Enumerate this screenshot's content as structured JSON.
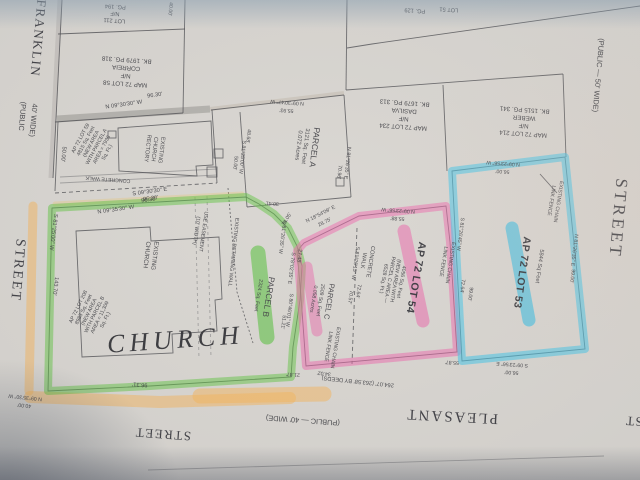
{
  "streets": {
    "left": {
      "name": "FRANKLIN",
      "designation_line1": "(PUBLIC",
      "designation_line2": "40' WIDE)",
      "word": "STREET"
    },
    "right": {
      "designation": "(PUBLIC   —   50' WIDE)",
      "word": "STREET"
    },
    "bottom": {
      "name": "PLEASANT",
      "designation": "(PUBLIC   —   40' WIDE)",
      "word": "STREET",
      "fragment": "ST"
    }
  },
  "abutters": {
    "lot211": [
      "LOT 211",
      "N/F",
      "PG. 194"
    ],
    "lot58": [
      "MAP 72 LOT 58",
      "N/F",
      "CORREIA",
      "BK. 1979 PG. 318"
    ],
    "lot234": [
      "MAP 72 LOT 234",
      "N/F",
      "DASILVA",
      "BK. 1679 PG. 313"
    ],
    "lot214": [
      "MAP 72 LOT 214",
      "N/F",
      "WEBER",
      "BK. 1515 PG. 341"
    ],
    "lot51_fragment": "LOT 51",
    "lot51_book_fragment": "PG. 129"
  },
  "subject_parcels": {
    "lot59": [
      "AP 72 LOT 59",
      "4815 Sq. Feet",
      "(NEW AREA",
      "WITH PARCEL A",
      "AREA = 7936",
      "Sq. Ft.)"
    ],
    "lot208": [
      "AP 72 LOT 208",
      "8985 Sq. Feet",
      "(NEW AREA",
      "WITH PARCEL B",
      "AREA = 11,309",
      "Sq. Ft.)"
    ],
    "parcel_a": [
      "PARCEL A",
      "3121 Sq. Feet",
      "0.072 Acres"
    ],
    "parcel_b": [
      "PARCEL B",
      "2324 Sq. Feet"
    ],
    "parcel_c": [
      "PARCEL C",
      "2509 Sq. Feet",
      "0.058 Acres"
    ],
    "lot54_title": "AP 72 LOT 54",
    "lot54_details": [
      "4056 Sq. Feet",
      "(NEW AREA WITH",
      "PARCEL C AREA —",
      "6528 Sq. Ft.)"
    ],
    "lot53_title": "AP 72 LOT 53",
    "lot53_area": "5844 Sq Feet"
  },
  "features": {
    "church": "CHURCH",
    "existing_church": [
      "EXISTING",
      "CHURCH"
    ],
    "rectory": [
      "EXISTING",
      "CHURCH",
      "RECTORY"
    ],
    "concrete_walk": "CONCRETE WALK",
    "concrete_walk2": [
      "CONCRETE",
      "WALK"
    ],
    "use_easement": [
      "USE EASEMENT",
      "(10' WIDTH)"
    ],
    "retaining_wall": "EXISTING RETAINING WALL",
    "chain_fence": [
      "EXISTING CHAIN",
      "LINK FENCE"
    ]
  },
  "dimensions": {
    "rectory_north_bearing": "N 09°30'30\" W",
    "rectory_north_dist": "96.30'",
    "rectory_south_bearing": "S 09°30'30\" E",
    "rectory_south_dist": "96.30'",
    "rectory_west_dist": "50.00'",
    "green_north_bearing": "N 09°35'30\" W",
    "green_north_dist": "96.30'",
    "green_west_bearing": "S 81°25'00\" W",
    "green_west_dist": "143.70'",
    "green_south_dist": "96.31'",
    "green_sw_bearing": "N 09°35'30\" W",
    "green_sw_dist": "40.00'",
    "zig_dist1": "30.41'",
    "zig_dist2": "24.05'",
    "zig_bearing1": "S 81°26'35\" W",
    "zig_bearing2": "S 78°02'35\" E",
    "zig_dist3": "27.48'",
    "zig_bearing3": "S 80°46'01\" W",
    "zig_dist4": "51.21'",
    "zig_dist5": "21.87'",
    "parcel_a_north_bearing": "N 09°30'47\" W",
    "parcel_a_north_dist": "55.93'",
    "parcel_a_east_bearing": "N 81°26'35\" E",
    "parcel_a_east_dist": "70.96'",
    "parcel_a_west_dist1": "48.68'",
    "parcel_a_west_bearing": "S 81°25'00\" W",
    "parcel_a_west_dist2": "50.00'",
    "pink_diag_bearing": "N 18°54'09\" E",
    "pink_diag_dist": "28.75'",
    "pink_top_bearing": "N 09°23'56\" W",
    "pink_top_dist": "55.88'",
    "shared_bearing": "S 81°26'45\" W",
    "shared_dist1": "72.64'",
    "shared_dist2": "99.00'",
    "pink_mid_bearing": "S 81°26'15\" W",
    "pink_mid_dist1": "72.64'",
    "pink_mid_dist2": "70.57'",
    "pink_south_dist": "55.87'",
    "deed_frontage": "264.07'   (263.58' BY DEEDS)",
    "deed_frontage2": "34.02'",
    "blue_north_bearing": "N 09°23'56\" W",
    "blue_north_dist": "56.00'",
    "blue_east_bearing": "N 81°26'35\" E",
    "blue_east_dist": "99.00'",
    "blue_south_bearing": "S 09°23'56\" E",
    "blue_south_dist": "56.00'",
    "franklin_top_dist": "40.00'"
  },
  "colors": {
    "highlight_green": "#5ec33d",
    "highlight_pink": "#ee64aa",
    "highlight_blue": "#41c4e8",
    "highlight_orange": "#f6b357",
    "ink": "#4b4b4f",
    "paper": "#d8d5d0"
  }
}
